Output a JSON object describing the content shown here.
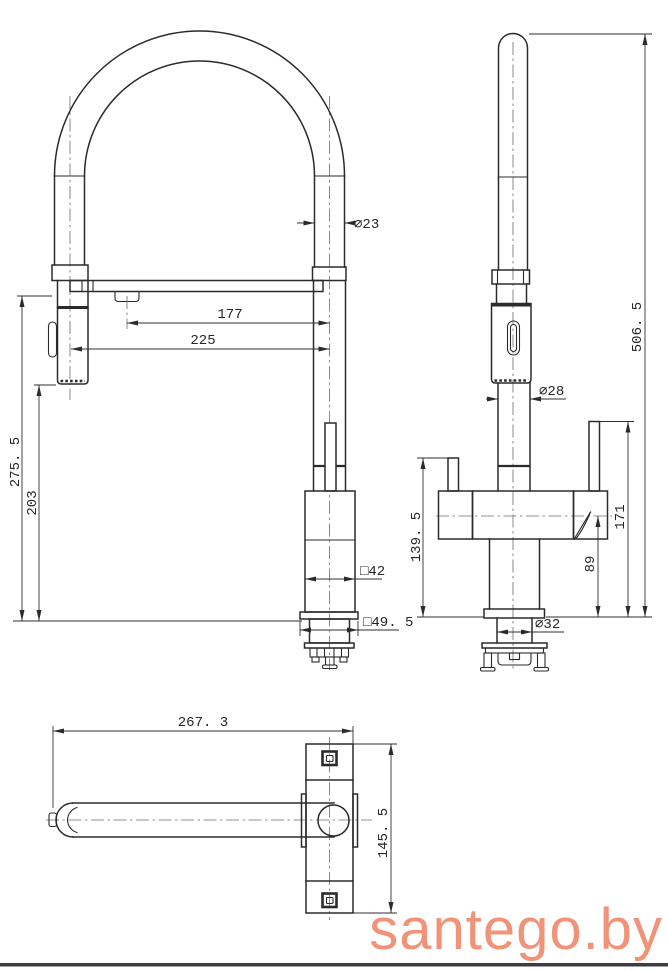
{
  "colors": {
    "background": "#ffffff",
    "line": "#2b2b2b",
    "watermark": "#f09379",
    "footer_bar": "#3c3c41"
  },
  "watermark": {
    "text": "santego.by"
  },
  "drawing": {
    "front_view": {
      "hose_diameter": "⌀23",
      "reach_inner": "177",
      "reach_total": "225",
      "height_to_arm": "275. 5",
      "height_to_spray": "203",
      "body_square": "□42",
      "base_square": "□49. 5"
    },
    "side_view": {
      "overall_height": "506. 5",
      "riser_diameter": "⌀28",
      "left_handle_height": "139. 5",
      "spout_axis_height": "89",
      "handle_top_height": "171",
      "base_diameter": "⌀32"
    },
    "bottom_view": {
      "overall_length": "267. 3",
      "overall_depth": "145. 5"
    }
  }
}
